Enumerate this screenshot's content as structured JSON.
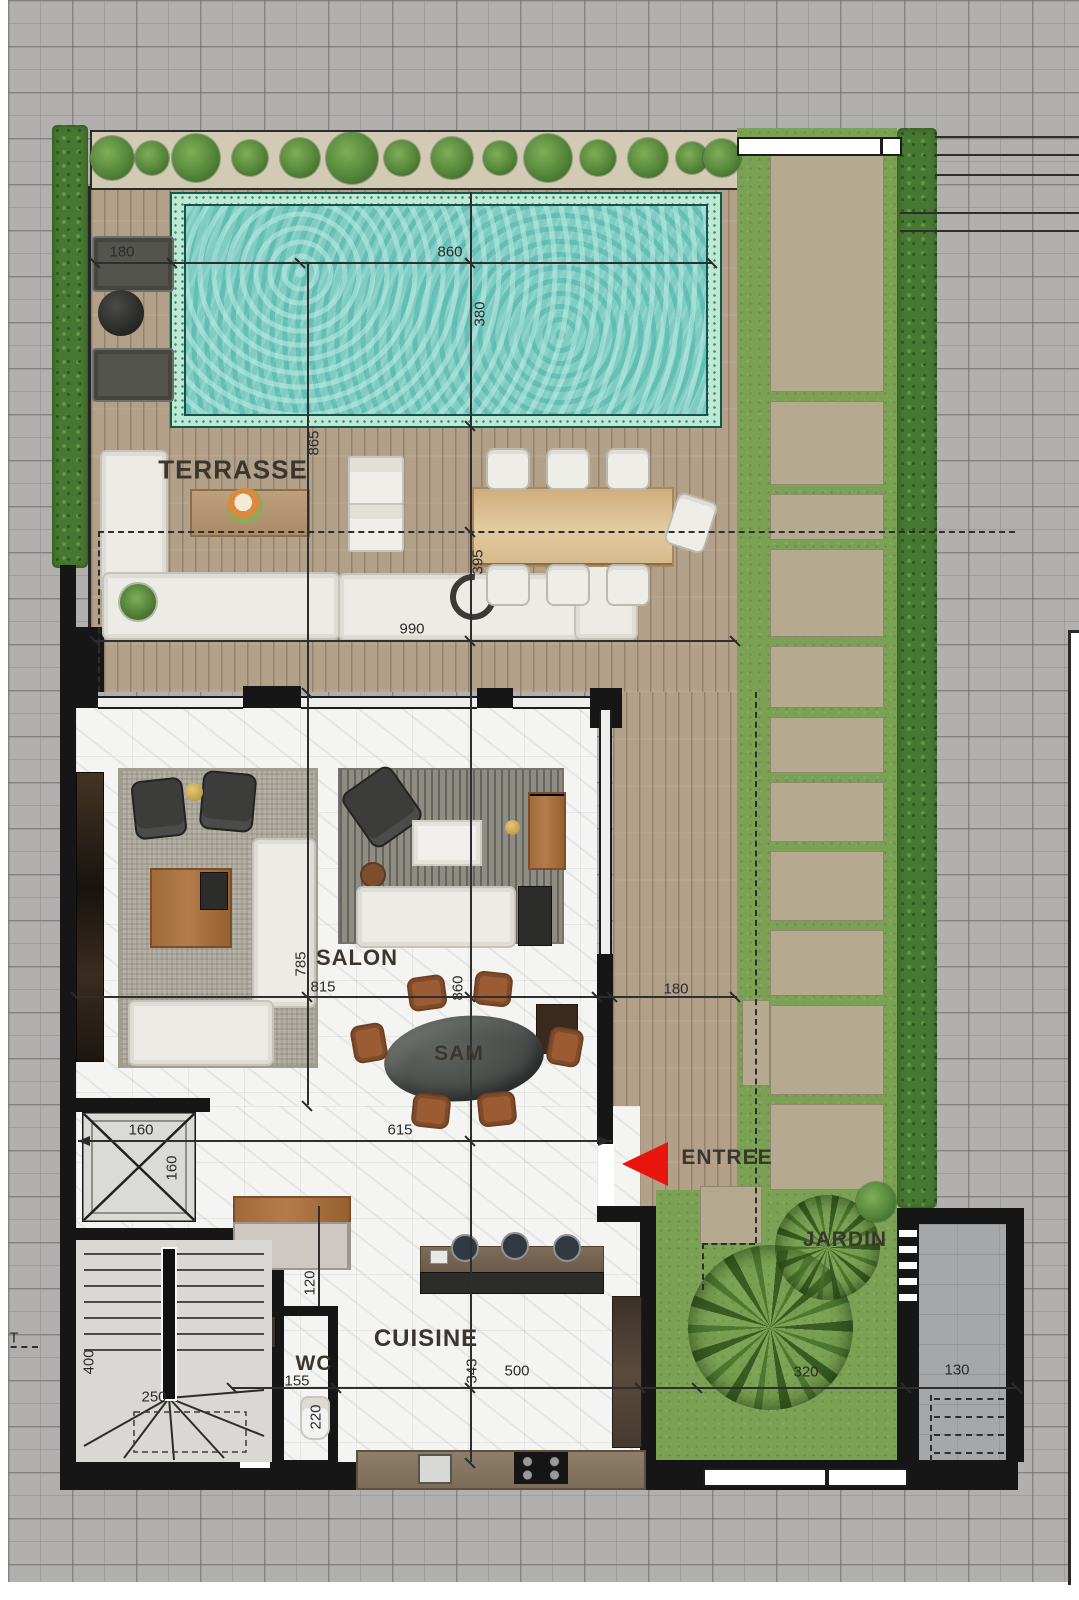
{
  "plan": {
    "type": "villa-ground-floor-plan",
    "room_labels": [
      {
        "id": "terrasse",
        "text": "TERRASSE",
        "x": 233,
        "y": 470,
        "size": 26
      },
      {
        "id": "salon",
        "text": "SALON",
        "x": 357,
        "y": 958,
        "size": 22
      },
      {
        "id": "sam",
        "text": "SAM",
        "x": 459,
        "y": 1054,
        "size": 21
      },
      {
        "id": "cuisine",
        "text": "CUISINE",
        "x": 426,
        "y": 1339,
        "size": 24
      },
      {
        "id": "wc",
        "text": "WC",
        "x": 314,
        "y": 1364,
        "size": 21
      },
      {
        "id": "entree",
        "text": "ENTREE",
        "x": 727,
        "y": 1158,
        "size": 21
      },
      {
        "id": "jardin",
        "text": "JARDIN",
        "x": 845,
        "y": 1240,
        "size": 21
      }
    ],
    "dimensions": [
      {
        "text": "180",
        "x": 122,
        "y": 252,
        "rot": 0
      },
      {
        "text": "860",
        "x": 450,
        "y": 252,
        "rot": 0
      },
      {
        "text": "380",
        "x": 480,
        "y": 314,
        "rot": 1
      },
      {
        "text": "865",
        "x": 314,
        "y": 443,
        "rot": 1
      },
      {
        "text": "395",
        "x": 478,
        "y": 562,
        "rot": 1
      },
      {
        "text": "990",
        "x": 412,
        "y": 629,
        "rot": 0
      },
      {
        "text": "785",
        "x": 301,
        "y": 964,
        "rot": 1
      },
      {
        "text": "815",
        "x": 323,
        "y": 987,
        "rot": 0
      },
      {
        "text": "860",
        "x": 458,
        "y": 988,
        "rot": 1
      },
      {
        "text": "180",
        "x": 676,
        "y": 989,
        "rot": 0
      },
      {
        "text": "160",
        "x": 141,
        "y": 1130,
        "rot": 0
      },
      {
        "text": "160",
        "x": 172,
        "y": 1168,
        "rot": 1
      },
      {
        "text": "615",
        "x": 400,
        "y": 1130,
        "rot": 0
      },
      {
        "text": "120",
        "x": 310,
        "y": 1283,
        "rot": 1
      },
      {
        "text": "400",
        "x": 89,
        "y": 1362,
        "rot": 1
      },
      {
        "text": "250",
        "x": 154,
        "y": 1397,
        "rot": 0
      },
      {
        "text": "155",
        "x": 297,
        "y": 1381,
        "rot": 0
      },
      {
        "text": "220",
        "x": 316,
        "y": 1417,
        "rot": 1
      },
      {
        "text": "343",
        "x": 472,
        "y": 1371,
        "rot": 1
      },
      {
        "text": "500",
        "x": 517,
        "y": 1371,
        "rot": 0
      },
      {
        "text": "320",
        "x": 806,
        "y": 1372,
        "rot": 0
      },
      {
        "text": "130",
        "x": 957,
        "y": 1370,
        "rot": 0
      },
      {
        "text": "T",
        "x": 14,
        "y": 1338,
        "rot": 0
      }
    ],
    "colors": {
      "paving": "#b1b0ae",
      "deck": "#b3a088",
      "pool_water": "#7fccc3",
      "pool_tile": "#bfe9d2",
      "pool_edge": "#17574a",
      "grass": "#7ba254",
      "hedge": "#477831",
      "stone_path": "#b5a98f",
      "marble": "#f4f4f3",
      "wall": "#161616",
      "rug_a": "#b4b0a4",
      "rug_b": "#8f8c84",
      "white_furn": "#edebe5",
      "dark_furn": "#3c3c3a",
      "sam_chair": "#9b5c33",
      "entry_red": "#e8150e",
      "dim_text": "#2b2b2b",
      "label_text": "#3a352e"
    }
  }
}
